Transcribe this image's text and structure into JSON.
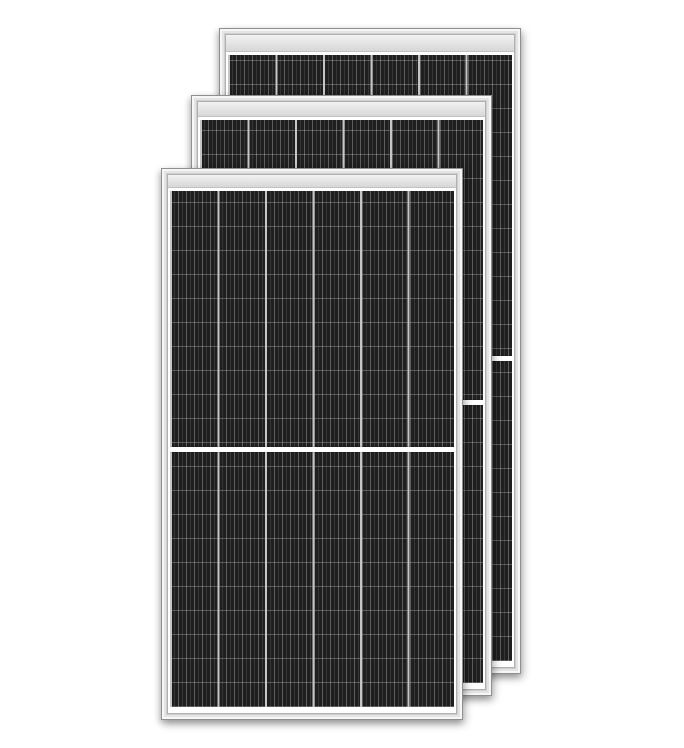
{
  "image": {
    "type": "product-photo",
    "subject": "Three framed monocrystalline half-cut solar panels overlapping diagonally on a white background",
    "panel_count": 3
  },
  "panels": [
    {
      "id": "back",
      "position": "top-right",
      "center_divider": true,
      "columns": 6
    },
    {
      "id": "middle",
      "position": "center",
      "center_divider": true,
      "columns": 6
    },
    {
      "id": "front",
      "position": "bottom-left",
      "center_divider": true,
      "columns": 6
    }
  ],
  "colors": {
    "background": "#ffffff",
    "frame_outline": "#8f8f8f",
    "frame_light": "#f6f6f6",
    "frame_mid": "#e4e4e4",
    "frame_dark": "#cfcfcf",
    "inner_edge": "#b0b0b0",
    "band_top": "#f2f2f2",
    "band_bottom": "#d7d7d7",
    "backsheet": "#ffffff",
    "cell_base": "#1f1f1f",
    "cell_finger": "rgba(255,255,255,0.10)",
    "cell_finger_bright": "rgba(255,255,255,0.20)",
    "row_line": "rgba(255,255,255,0.25)",
    "col_divider": "#c6c6c6",
    "divider": "#ffffff",
    "shadow": "rgba(0,0,0,0.30)"
  }
}
